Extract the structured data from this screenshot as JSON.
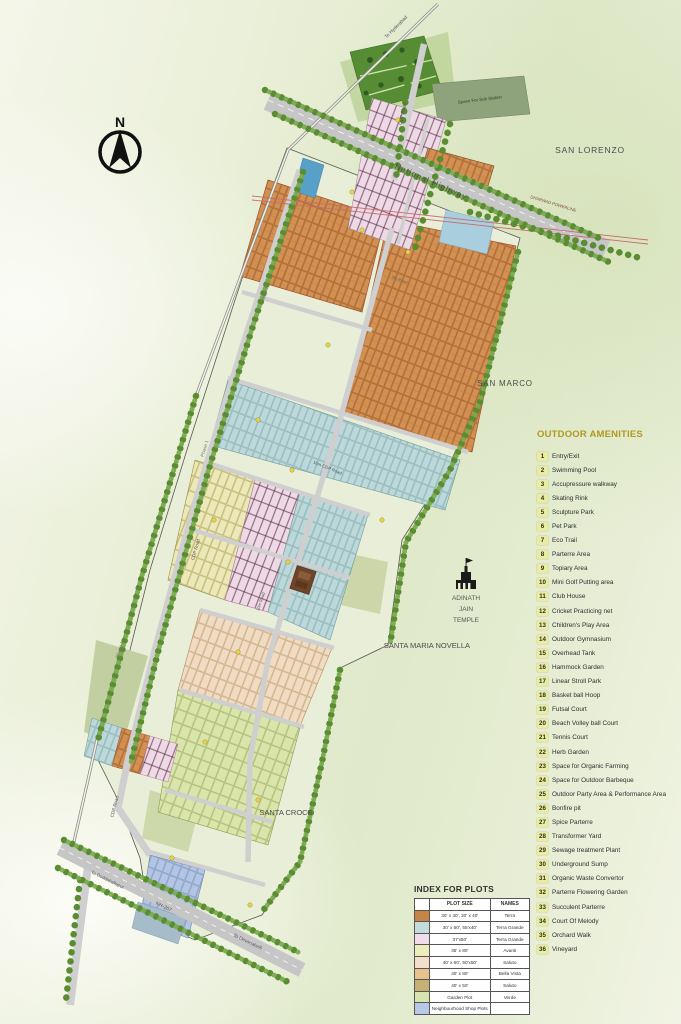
{
  "map": {
    "compass": {
      "north": "N"
    },
    "labels": {
      "to_hyderabad": "To Hyderabad",
      "cdp_road_top": "CDP Road",
      "space_sub_station": "Space For Sub Station",
      "national_highway": "National Highway",
      "powerline": "DHARWAD POWERLINE",
      "san_lorenzo": "SAN LORENZO",
      "road_9": "9th Road",
      "road_16m_cdp": "16m CDP Road",
      "san_marco": "SAN MARCO",
      "phase_3": "Phase 3",
      "phase_1a": "Phase 1",
      "phase_1b": "Phase 1",
      "cdp_road_mid": "CDP Road",
      "road_10m": "10m Road",
      "cdp_road_bottom": "CDP Road",
      "temple_line1": "ADINATH",
      "temple_line2": "JAIN",
      "temple_line3": "TEMPLE",
      "santa_maria_novella": "SANTA MARIA NOVELLA",
      "santa_croce": "SANTA CROCE",
      "nh_207": "NH-207",
      "to_doddaballapur": "To Doddaballapur",
      "to_devanahalli": "To Devanahalli"
    }
  },
  "amenities": {
    "title": "OUTDOOR AMENITIES",
    "number_bg": "#e9eca4",
    "items": [
      {
        "num": "1",
        "label": "Entry/Exit"
      },
      {
        "num": "2",
        "label": "Swimming Pool"
      },
      {
        "num": "3",
        "label": "Accupressure walkway"
      },
      {
        "num": "4",
        "label": "Skating Rink"
      },
      {
        "num": "5",
        "label": "Sculpture Park"
      },
      {
        "num": "6",
        "label": "Pet Park"
      },
      {
        "num": "7",
        "label": "Eco Trail"
      },
      {
        "num": "8",
        "label": "Parterre Area"
      },
      {
        "num": "9",
        "label": "Topiary Area"
      },
      {
        "num": "10",
        "label": "Mini Golf Putting area"
      },
      {
        "num": "11",
        "label": "Club House"
      },
      {
        "num": "12",
        "label": "Cricket Practicing net"
      },
      {
        "num": "13",
        "label": "Children's Play Area"
      },
      {
        "num": "14",
        "label": "Outdoor Gymnasium"
      },
      {
        "num": "15",
        "label": "Overhead Tank"
      },
      {
        "num": "16",
        "label": "Hammock Garden"
      },
      {
        "num": "17",
        "label": "Linear Stroll Park"
      },
      {
        "num": "18",
        "label": "Basket ball Hoop"
      },
      {
        "num": "19",
        "label": "Futsal Court"
      },
      {
        "num": "20",
        "label": "Beach Volley ball Court"
      },
      {
        "num": "21",
        "label": "Tennis Court"
      },
      {
        "num": "22",
        "label": "Herb Garden"
      },
      {
        "num": "23",
        "label": "Space for Organic Farming"
      },
      {
        "num": "24",
        "label": "Space for Outdoor Barbeque"
      },
      {
        "num": "25",
        "label": "Outdoor Party Area & Performance Area"
      },
      {
        "num": "26",
        "label": "Bonfire pit"
      },
      {
        "num": "27",
        "label": "Spice Parterre"
      },
      {
        "num": "28",
        "label": "Transformer Yard"
      },
      {
        "num": "29",
        "label": "Sewage treatment Plant"
      },
      {
        "num": "30",
        "label": "Underground Sump"
      },
      {
        "num": "31",
        "label": "Organic Waste Convertor"
      },
      {
        "num": "32",
        "label": "Parterre Flowering Garden"
      },
      {
        "num": "33",
        "label": "Succulent Parterre"
      },
      {
        "num": "34",
        "label": "Court Of Melody"
      },
      {
        "num": "35",
        "label": "Orchard Walk"
      },
      {
        "num": "36",
        "label": "Vineyard"
      }
    ]
  },
  "plot_index": {
    "title": "INDEX FOR PLOTS",
    "headers": {
      "size": "PLOT SIZE",
      "names": "NAMES"
    },
    "rows": [
      {
        "color": "#c68448",
        "size": "30' x 40', 20' x 40'",
        "name": "Terra"
      },
      {
        "color": "#c3dcd9",
        "size": "30' x 50', 55'x40'",
        "name": "Terra Grande"
      },
      {
        "color": "#f0dcea",
        "size": "37'x50'",
        "name": "Terra Grande"
      },
      {
        "color": "#ececbc",
        "size": "35' x 80'",
        "name": "Avanti"
      },
      {
        "color": "#f3dfca",
        "size": "40' x 60', 50'x50'",
        "name": "Saluto"
      },
      {
        "color": "#e7c28c",
        "size": "40' x 80'",
        "name": "Bella Vista"
      },
      {
        "color": "#c6b075",
        "size": "40' x 50'",
        "name": "Saluto"
      },
      {
        "color": "#d8e4ad",
        "size": "Garden Plot",
        "name": "Verde"
      },
      {
        "color": "#b6c8e5",
        "size": "Neighbourhood Shop Plots",
        "name": ""
      }
    ]
  }
}
